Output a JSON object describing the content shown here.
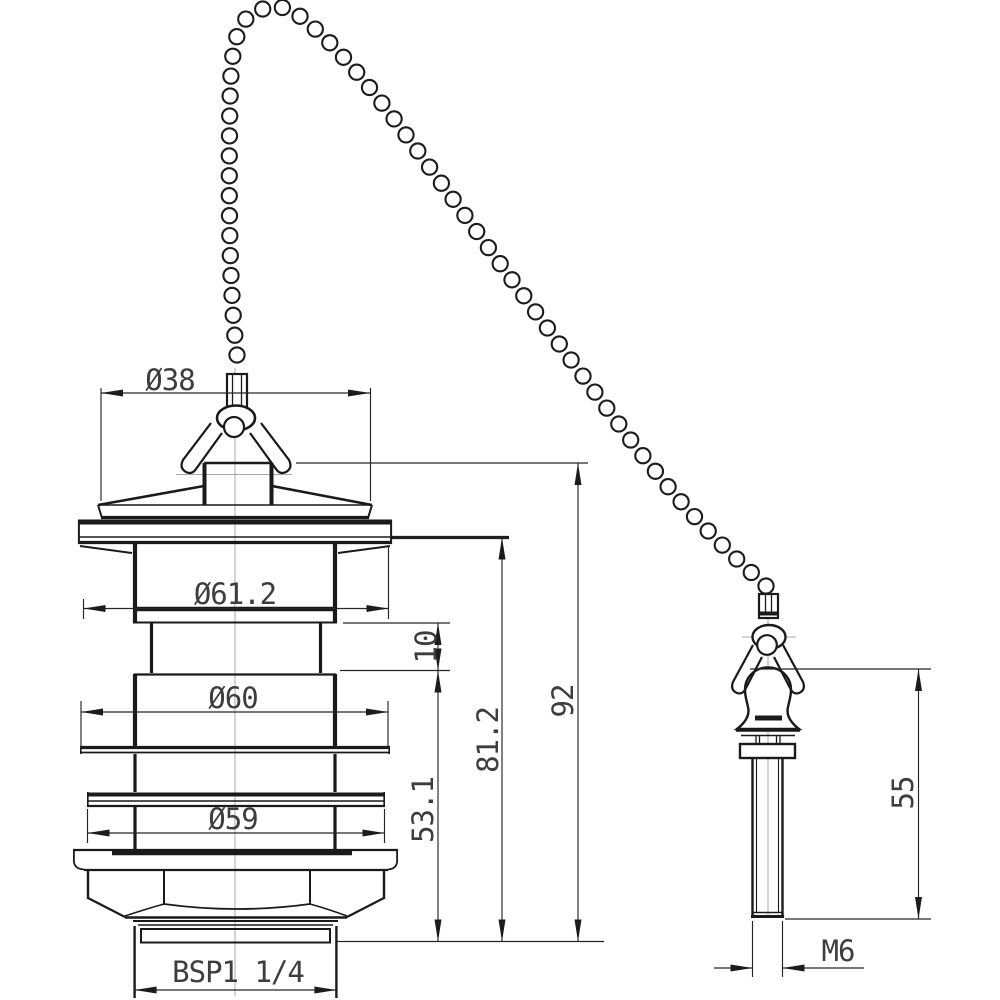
{
  "drawing": {
    "type": "technical-dimension-drawing",
    "dimensions": {
      "plug_diameter": "Ø38",
      "flange_diameter": "Ø61.2",
      "upper_washer_diameter": "Ø60",
      "lower_washer_diameter": "Ø59",
      "neck_height": "10",
      "lower_section_height": "53.1",
      "body_height": "81.2",
      "overall_height": "92",
      "stay_length": "55",
      "stay_thread": "M6",
      "tail_thread": "BSP1 1/4"
    },
    "colors": {
      "outline": "#1a1a1a",
      "dimension_line": "#262626",
      "dimension_text": "#3d3d3d",
      "centerline": "#a8a8a8",
      "background": "#ffffff"
    },
    "chain": {
      "path": "M 237 355 C 230 300 228 210 230 100 C 231 54 235 24 252 14 C 267 5 284 4 297 14 C 324 34 355 67 398 124 C 462 211 545 326 630 439 C 690 518 729 552 766 586",
      "bead_radius": 7.6,
      "bead_spacing": 19.8
    }
  }
}
